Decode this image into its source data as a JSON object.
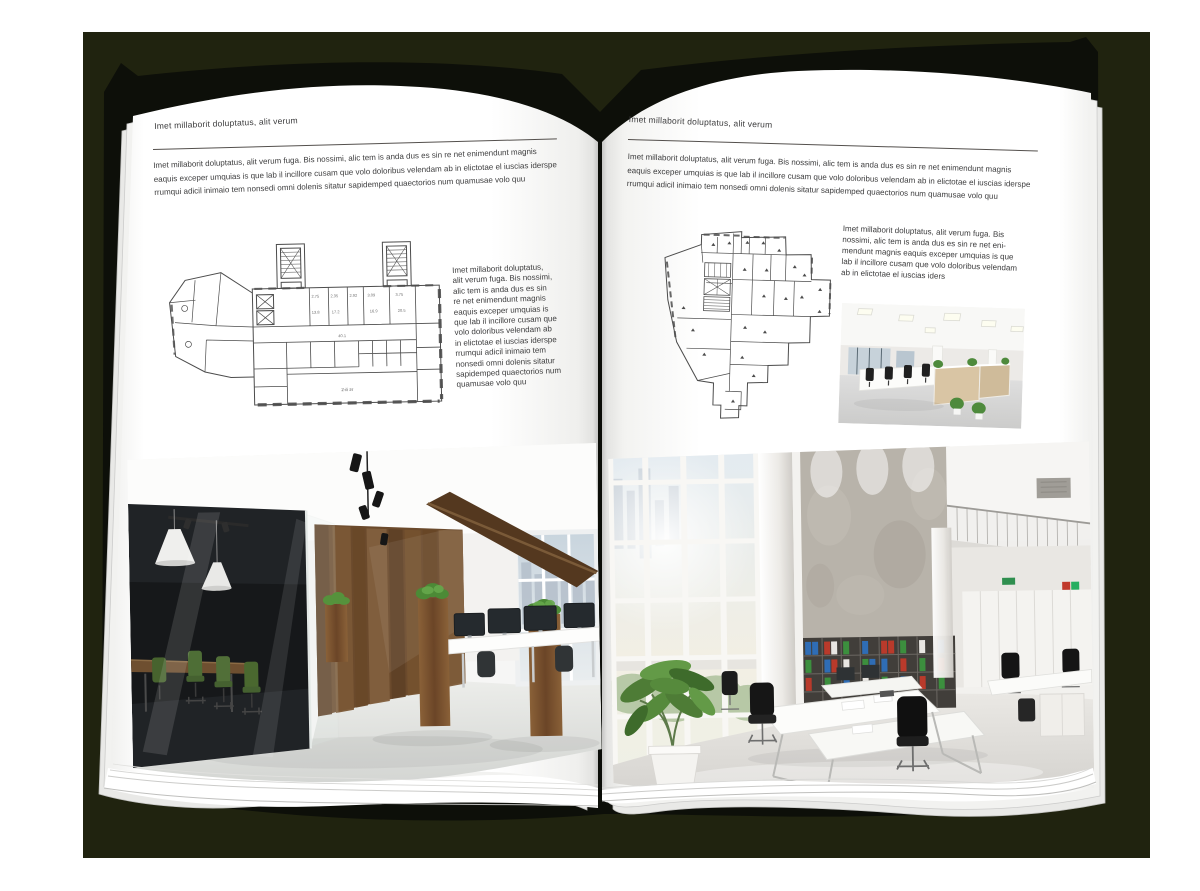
{
  "palette": {
    "backdrop": "#20230f",
    "cover": "#0d0f09",
    "page": "#ffffff",
    "text": "#3c3c3d",
    "rule": "#54504d",
    "plan_line": "#4c4c4c",
    "photo_green": "#4e6e36",
    "photo_wood": "#6b4a2c"
  },
  "left_page": {
    "header": "Imet millaborit doluptatus, alit verum",
    "intro": "Imet millaborit doluptatus, alit verum fuga. Bis nossimi, alic tem is anda dus es sin re net enimendunt magnis\neaquis exceper umquias is que lab il incillore cusam que volo doloribus velendam ab in elictotae el iuscias iderspe\nrrumqui adicil inimaio tem nonsedi omni dolenis sitatur sapidemped quaectorios num quamusae volo quu",
    "side_text": "Imet millaborit doluptatus,\nalit verum fuga. Bis nossimi,\nalic tem is anda dus es sin\nre net enimendunt magnis\neaquis exceper umquias is\nque lab il incillore cusam que\nvolo doloribus velendam ab\nin elictotae el iuscias iderspe\nrrumqui adicil inimaio tem\nnonsedi omni dolenis sitatur\nsapidemped quaectorios num\nquamusae volo quu",
    "plan_caption": "2-й эт",
    "plan_labels": [
      "2.75",
      "2.35",
      "2.92",
      "3.09",
      "3.75",
      "13.8",
      "17.2",
      "16.9",
      "20.5",
      "40.1"
    ]
  },
  "right_page": {
    "header": "Imet millaborit doluptatus, alit verum",
    "intro": "Imet millaborit doluptatus, alit verum fuga. Bis nossimi, alic tem is anda dus es sin re net enimendunt magnis\neaquis exceper umquias is que lab il incillore cusam que volo doloribus velendam ab in elictotae el iuscias iderspe\nrrumqui adicil inimaio tem nonsedi omni dolenis sitatur sapidemped quaectorios num quamusae volo quu",
    "side_text": "Imet millaborit doluptatus, alit verum fuga. Bis\nnossimi, alic tem is anda dus es sin re net eni-\nmendunt magnis eaquis exceper umquias is que\nlab il incillore cusam que volo doloribus velendam\nab in elictotae el iuscias iders"
  }
}
